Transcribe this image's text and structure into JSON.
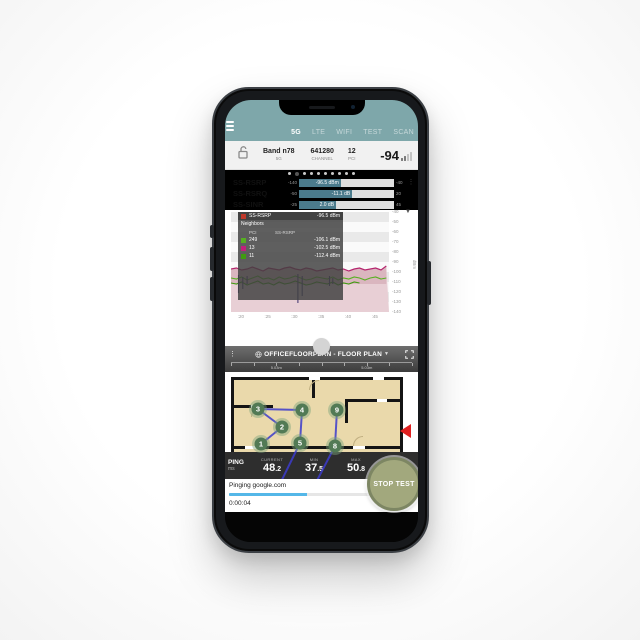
{
  "app": {
    "tabs": [
      {
        "label": "5G",
        "active": true
      },
      {
        "label": "LTE",
        "active": false
      },
      {
        "label": "WIFI",
        "active": false
      },
      {
        "label": "TEST",
        "active": false
      },
      {
        "label": "SCAN",
        "active": false
      }
    ],
    "info_bar": {
      "band": "Band n78",
      "band_sub": "5G",
      "channel": "641280",
      "channel_sub": "CHANNEL",
      "pci": "12",
      "pci_sub": "PCI",
      "level": "-94"
    },
    "page_dots": {
      "count": 10,
      "active_index": 1
    },
    "measurements": [
      {
        "label": "SS-RSRP",
        "min": "-140",
        "max": "-40",
        "value": -96.5,
        "display": "-96.5 dBm",
        "min_num": -140,
        "max_num": -40
      },
      {
        "label": "SS-RSRQ",
        "min": "-50",
        "max": "20",
        "value": -11.1,
        "display": "-11.1 dB",
        "min_num": -50,
        "max_num": 20
      },
      {
        "label": "SS-SINR",
        "min": "-25",
        "max": "45",
        "value": 2.0,
        "display": "2.0 dB",
        "min_num": -25,
        "max_num": 45
      }
    ],
    "legend": {
      "serving_label": "SS-RSRP",
      "serving_value": "-96.5 dBm",
      "serving_color": "#c0392b",
      "neighbors_title": "Neighbors",
      "col_pci": "PCI",
      "col_val": "SS-RSRP",
      "rows": [
        {
          "pci": "249",
          "value": "-106.1 dBm",
          "color": "#56b021"
        },
        {
          "pci": "13",
          "value": "-102.5 dBm",
          "color": "#c21f7c"
        },
        {
          "pci": "11",
          "value": "-112.4 dBm",
          "color": "#3f9b0f"
        }
      ]
    },
    "floorplan": {
      "title": "OFFICEFLOORPLAN - FLOOR PLAN",
      "scale_labels": [
        "5.03m",
        "5.03m"
      ],
      "waypoints": [
        {
          "n": "1",
          "x": 36,
          "y": 72
        },
        {
          "n": "2",
          "x": 57,
          "y": 55
        },
        {
          "n": "3",
          "x": 33,
          "y": 37
        },
        {
          "n": "4",
          "x": 77,
          "y": 38
        },
        {
          "n": "5",
          "x": 75,
          "y": 71
        },
        {
          "n": "8",
          "x": 110,
          "y": 74
        },
        {
          "n": "9",
          "x": 112,
          "y": 38
        }
      ],
      "path_segments": [
        [
          36,
          72,
          57,
          55
        ],
        [
          57,
          55,
          33,
          37
        ],
        [
          33,
          37,
          77,
          38
        ],
        [
          77,
          38,
          75,
          71
        ],
        [
          75,
          71,
          50,
          122
        ],
        [
          110,
          74,
          112,
          38
        ],
        [
          110,
          74,
          85,
          122
        ]
      ],
      "path_color": "#3d3ccc",
      "marker_color": "#e02020"
    },
    "ping": {
      "title": "PING",
      "unit": "ms",
      "stats": [
        {
          "label": "CURRENT",
          "value": "48.2"
        },
        {
          "label": "MIN",
          "value": "37.5"
        },
        {
          "label": "MAX",
          "value": "50.8"
        }
      ]
    },
    "test": {
      "status": "Pinging google.com",
      "progress_pct": 42,
      "elapsed": "0:00:04",
      "stop_label": "STOP TEST"
    }
  },
  "chart_data": {
    "type": "line",
    "ylabel": "dBm",
    "ylim": [
      -140,
      -40
    ],
    "xlim": [
      18,
      47.5
    ],
    "y_ticks": [
      -40,
      -50,
      -60,
      -70,
      -80,
      -90,
      -100,
      -110,
      -120,
      -130,
      -140
    ],
    "x_ticks": [
      {
        "v": 20,
        "label": ":20"
      },
      {
        "v": 25,
        "label": ":25"
      },
      {
        "v": 30,
        "label": ":30"
      },
      {
        "v": 35,
        "label": ":35"
      },
      {
        "v": 40,
        "label": ":40"
      },
      {
        "v": 45,
        "label": ":45"
      }
    ],
    "band_colors": [
      "#e9e9e9",
      "#fafafa"
    ],
    "series": [
      {
        "name": "SS-RSRP serving",
        "color": "#b5256e",
        "area_fill": "#e8cfd5",
        "area_fill_dark": "#cda3ad",
        "type": "area-line",
        "x": [
          18,
          19,
          20,
          21,
          22,
          23,
          24,
          25,
          26,
          27,
          28,
          29,
          30,
          31,
          32,
          33,
          34,
          35,
          36,
          37,
          38,
          39,
          40,
          41,
          42,
          43,
          44,
          45,
          46,
          47
        ],
        "y": [
          -97,
          -96,
          -98,
          -97,
          -95,
          -97,
          -99,
          -96,
          -97,
          -98,
          -96,
          -95,
          -97,
          -98,
          -96,
          -97,
          -99,
          -98,
          -97,
          -96,
          -98,
          -97,
          -99,
          -97,
          -96,
          -98,
          -97,
          -96,
          -98,
          -94
        ]
      },
      {
        "name": "PCI 249",
        "color": "#56b021",
        "type": "line",
        "x": [
          18,
          19,
          20,
          21,
          22,
          23,
          24,
          25,
          26,
          27,
          28,
          29,
          30,
          31,
          32,
          33,
          34,
          35,
          36,
          37,
          38,
          39,
          40,
          41,
          42,
          43,
          44,
          45,
          46,
          47
        ],
        "y": [
          -106,
          -107,
          -105,
          -108,
          -106,
          -104,
          -107,
          -106,
          -108,
          -105,
          -107,
          -106,
          -104,
          -106,
          -108,
          -107,
          -105,
          -106,
          -107,
          -105,
          -108,
          -106,
          -107,
          -105,
          -106,
          -108,
          -106,
          -105,
          -107,
          -106
        ]
      },
      {
        "name": "PCI 11",
        "color": "#3f9b0f",
        "type": "line",
        "x": [
          18,
          19,
          20,
          21,
          22,
          23,
          24,
          25,
          26,
          27,
          28,
          29,
          30,
          31,
          32,
          33,
          34,
          35,
          36,
          37,
          38,
          39,
          40,
          41,
          42
        ],
        "y": [
          -111,
          -112,
          -110,
          -113,
          -111,
          -109,
          -112,
          -111,
          -113,
          -110,
          -112,
          -111,
          -109,
          -111,
          -113,
          -112,
          -110,
          -111,
          -112,
          -110,
          -113,
          -111,
          -112,
          -110,
          -111
        ]
      },
      {
        "name": "PCI 13 dips",
        "color": "#4a3f77",
        "type": "spikes",
        "segments": [
          [
            19.4,
            -103,
            -121
          ],
          [
            20.2,
            -105,
            -117
          ],
          [
            21,
            -104,
            -112
          ],
          [
            30.5,
            -102,
            -131
          ],
          [
            31.3,
            -104,
            -124
          ],
          [
            36.4,
            -104,
            -114
          ],
          [
            37,
            -106,
            -112
          ]
        ]
      }
    ]
  }
}
